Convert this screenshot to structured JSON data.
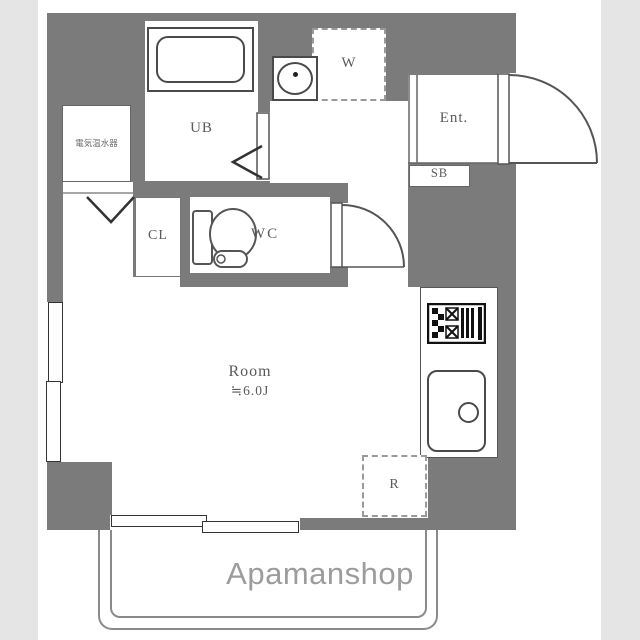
{
  "plan": {
    "labels": {
      "water_heater": "電気温水器",
      "unit_bath": "UB",
      "washer": "W",
      "entrance": "Ent.",
      "shoe_box": "SB",
      "closet": "CL",
      "toilet": "WC",
      "room_name": "Room",
      "room_size": "≒6.0J",
      "refrigerator": "R"
    },
    "watermark": "Apamanshop",
    "colors": {
      "wall": "#7b7b7b",
      "fixture_line": "#4a4a4a",
      "label_text": "#5a5a5a",
      "watermark_text": "#9c9c9c",
      "edge_band": "#e5e5e5",
      "background": "#ffffff"
    }
  }
}
